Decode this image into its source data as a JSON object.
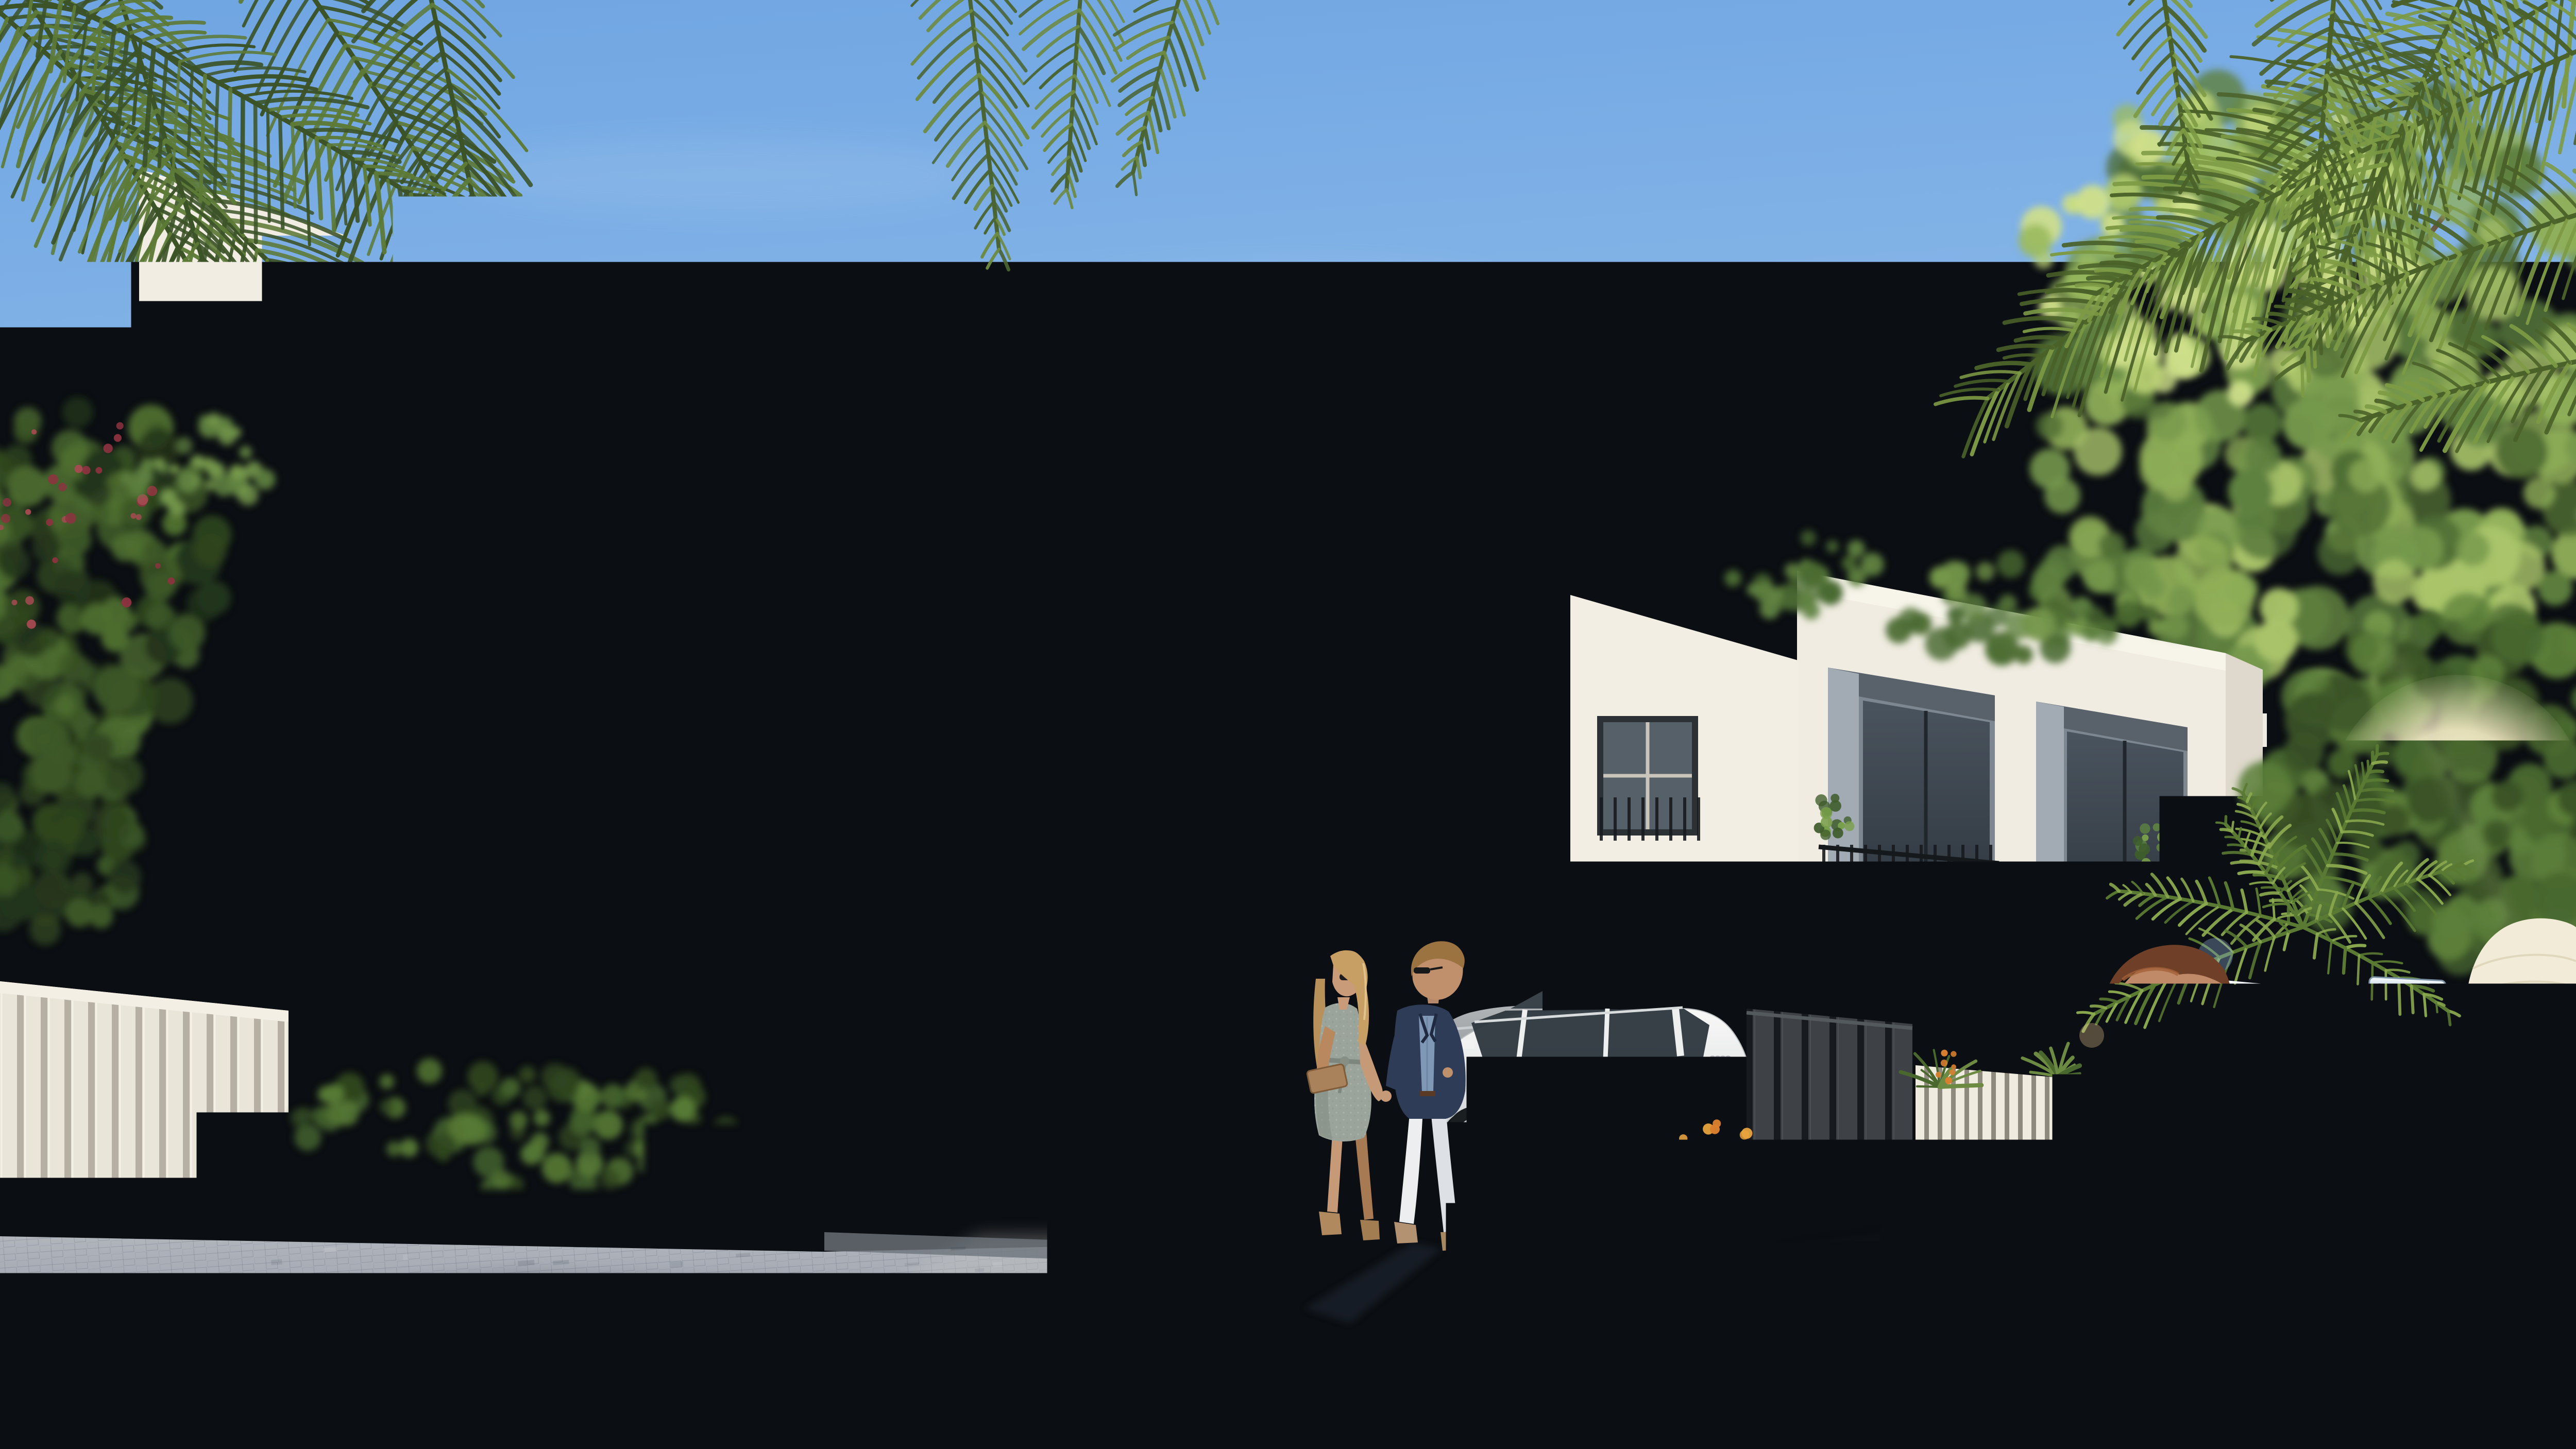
{
  "scene": {
    "type": "architectural-exterior-rendering",
    "description": "Sunlit modern two-storey townhouse row with recessed balconies, stone-clad carports, landscaped driveway, parked cars, a couple walking hand in hand, and a burgundy classic convertible with two occupants in the foreground",
    "lighting": "low sun glaring through trees on the right"
  },
  "sky": {
    "top_color": "#6fa5e2",
    "horizon_color": "#d7e5f3",
    "sun": "behind right-hand trees"
  },
  "architecture": {
    "style": "modern minimalist townhouses",
    "floors": 2,
    "facade_color": "#f0ece2",
    "balcony_recess_color": "#7d8791",
    "stone_band_color": "#c9c4b8",
    "stone_dark_color": "#5b636b",
    "railing_color": "#1b1f23",
    "fence_dark_color": "#3e4246",
    "fence_light_color": "#eae5d9"
  },
  "vehicles": {
    "classic_convertible": {
      "name": "burgundy classic roadster (foreground)",
      "badge_text": "300 SL",
      "emblem": "three-pointed-star",
      "paint_color": "#5a1f29",
      "chrome_color": "#cfe0ee",
      "occupants": [
        "man driving in white shirt",
        "woman passenger in white straw hat"
      ]
    },
    "white_suv": {
      "name": "white SUV parked in carport",
      "plate_number": "41424",
      "plate_accent_color": "#c8102e",
      "paint_color": "#f1f2f0",
      "brand_badge": "four-rings"
    },
    "grey_car": {
      "name": "grey car partially visible behind couple",
      "paint_color": "#a2a6a9"
    }
  },
  "people": {
    "walking_couple": {
      "woman": "grey patterned summer dress, sunglasses, long blonde hair, tan clutch",
      "man": "navy blazer, chambray shirt, white trousers, sunglasses, yellow folder"
    }
  },
  "landscape": {
    "palm_frond_color": "#53702f",
    "tree_color": "#5f8140",
    "flower_colors": [
      "#d97f2e",
      "#e5c02e",
      "#a03040",
      "#c04f55"
    ],
    "agave_colors": [
      "#6e8f3f",
      "#c6d36a"
    ],
    "pavement_color": "#949aa3"
  }
}
